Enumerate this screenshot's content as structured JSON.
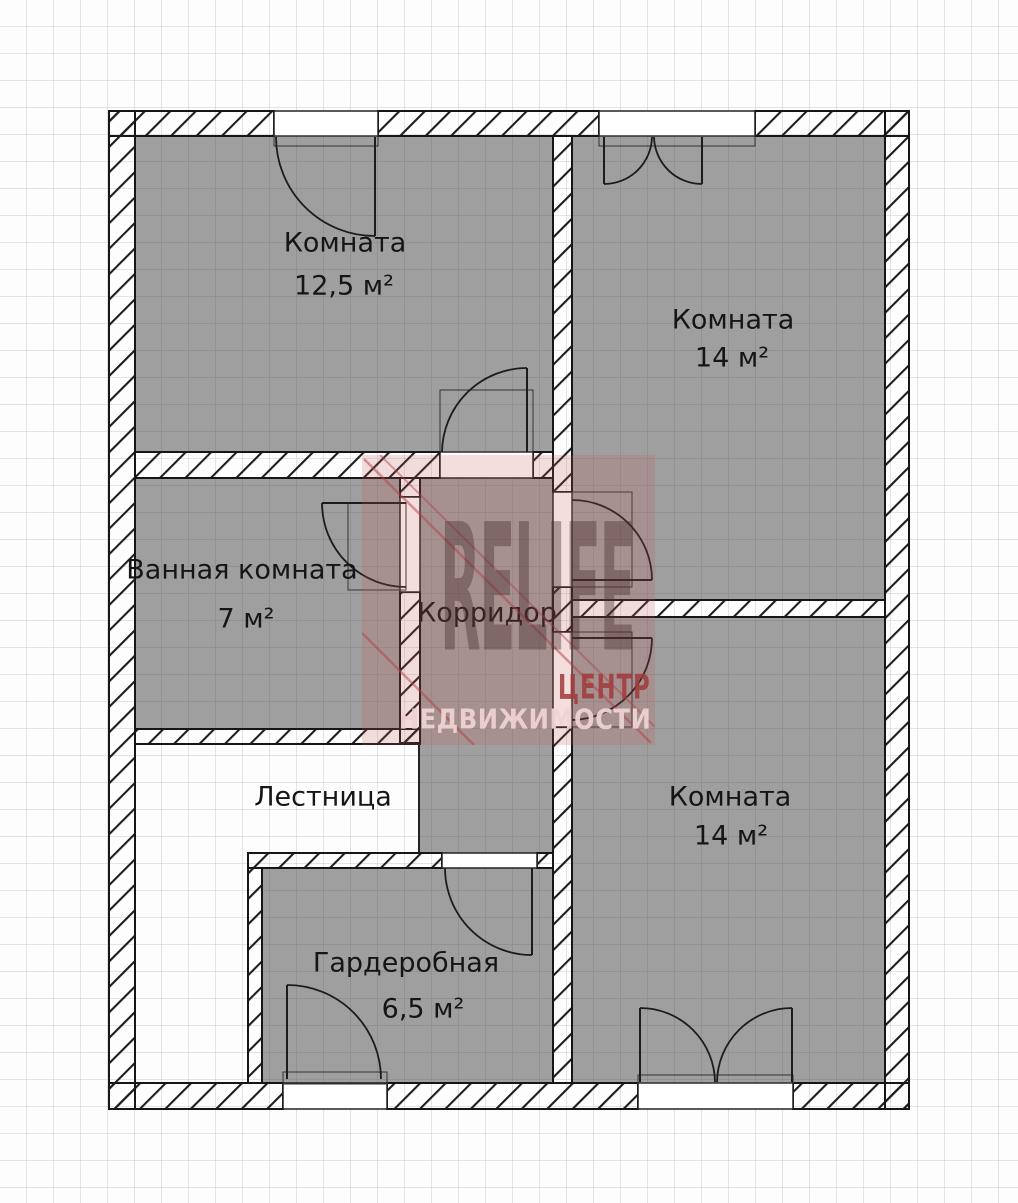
{
  "plan": {
    "rooms": [
      {
        "key": "room_top_left",
        "label": "Комната",
        "area": "12,5 м²"
      },
      {
        "key": "room_top_right",
        "label": "Комната",
        "area": "14 м²"
      },
      {
        "key": "bathroom",
        "label": "Ванная комната",
        "area": "7 м²"
      },
      {
        "key": "corridor",
        "label": "Корридор",
        "area": ""
      },
      {
        "key": "stairs",
        "label": "Лестница",
        "area": ""
      },
      {
        "key": "wardrobe",
        "label": "Гардеробная",
        "area": "6,5 м²"
      },
      {
        "key": "room_bottom_right",
        "label": "Комната",
        "area": "14 м²"
      }
    ]
  },
  "watermark": {
    "brand": "RELIFE",
    "tagline_line1": "ЦЕНТР",
    "tagline_line2": "НЕДВИЖИМОСТИ"
  },
  "colors": {
    "room_fill": "#9f9f9f",
    "background": "#fdfdfd",
    "grid_line_light": "#c8ccce",
    "wall_line": "#161616",
    "watermark_tint": "#c75454",
    "watermark_brand_text": "#483030",
    "watermark_light_text": "#eed3d3"
  }
}
